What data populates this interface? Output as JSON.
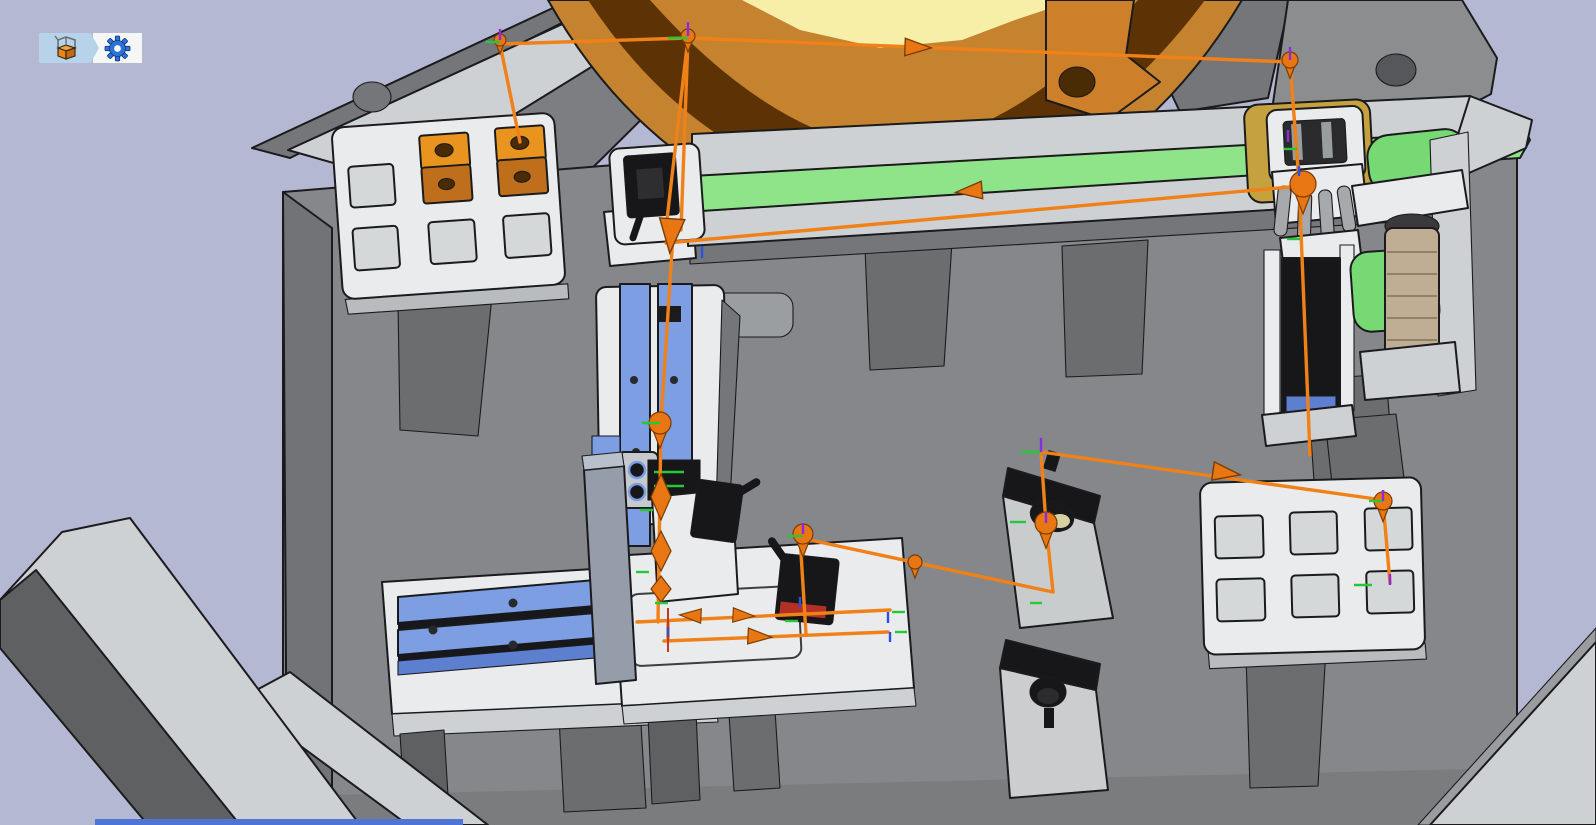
{
  "app": {
    "type": "3d-robot-simulation-viewport",
    "toolbar": {
      "buttons": [
        {
          "id": "workcell-component",
          "icon": "crate-3d-icon"
        },
        {
          "id": "settings",
          "icon": "gear-icon"
        }
      ]
    }
  },
  "colors": {
    "bg": "#b4b8d2",
    "plate": "#85878a",
    "plateChamfer": "#717376",
    "plateBottom": "#7a7c7e",
    "legDark": "#6b6d6f",
    "beamDark": "#5e6062",
    "grayLight": "#cdd1d3",
    "white": "#e9ebec",
    "pocket": "#d5d8d9",
    "blue": "#7d9ee2",
    "blueDeep": "#5d7fd0",
    "steel": "#959dab",
    "beltGreen": "#8fe48a",
    "blockGreen": "#77d973",
    "gold": "#c5a23f",
    "beige": "#bfae93",
    "black": "#17171a",
    "red": "#b33025",
    "bowlOrange": "#c5832f",
    "bowlBrown": "#5d3305",
    "bowlYellow": "#f7efa7",
    "cubeTop": "#e9941f",
    "cubeFront": "#bf6f1b",
    "holeDark": "#4a2c04",
    "outline": "#1b1b1d",
    "pathOrange": "#f08018",
    "arrowFill": "#e87612",
    "auxRed": "#c0392b",
    "tickGreen": "#27c837",
    "tickBlue": "#2a52e0",
    "tickPurple": "#8a2be2",
    "stripBlue": "#4f74d4",
    "toolbarBlue": "#b7d3e9",
    "toolbarWhite": "#f4f7f6",
    "gearBlue": "#2a72d9",
    "crateOrange": "#e8861c",
    "grayMid": "#7c7e81",
    "grayPanelA": "#74767a",
    "grayPanelB": "#8b8d8f",
    "barLight": "#b9bcbe"
  },
  "scene": {
    "parts": [
      "bowl-feeder",
      "conveyor",
      "conveyor-sensor",
      "left-pallet",
      "workpiece-cube-1",
      "workpiece-cube-2",
      "vertical-slide-unit",
      "horizontal-slide-unit",
      "assembly-fixture",
      "gripper-station",
      "pusher-slide",
      "feeder-motor",
      "inspection-stand-1",
      "inspection-stand-2",
      "right-pallet",
      "base-plate",
      "frame-beams",
      "robot-trajectory"
    ],
    "left_pallet": {
      "rows": 2,
      "cols": 3,
      "pockets": 6,
      "workpieces": 2
    },
    "right_pallet": {
      "rows": 2,
      "cols": 3,
      "pockets": 6,
      "workpieces": 0
    },
    "trajectory": {
      "segments": [
        [
          [
            520,
            142
          ],
          [
            500,
            44
          ],
          [
            688,
            38
          ],
          [
            1290,
            62
          ],
          [
            1299,
            182
          ],
          [
            1310,
            455
          ]
        ],
        [
          [
            688,
            38
          ],
          [
            666,
            228
          ]
        ],
        [
          [
            688,
            38
          ],
          [
            681,
            230
          ]
        ],
        [
          [
            673,
            235
          ],
          [
            661,
            422
          ],
          [
            658,
            622
          ]
        ],
        [
          [
            1301,
            186
          ],
          [
            666,
            243
          ]
        ],
        [
          [
            637,
            622
          ],
          [
            890,
            610
          ]
        ],
        [
          [
            668,
            622
          ],
          [
            668,
            641
          ]
        ],
        [
          [
            664,
            641
          ],
          [
            888,
            632
          ]
        ],
        [
          [
            800,
            537
          ],
          [
            806,
            634
          ]
        ],
        [
          [
            810,
            540
          ],
          [
            1053,
            592
          ]
        ],
        [
          [
            1053,
            592
          ],
          [
            1046,
            524
          ],
          [
            1041,
            452
          ]
        ],
        [
          [
            1041,
            452
          ],
          [
            1383,
            500
          ]
        ],
        [
          [
            1383,
            502
          ],
          [
            1390,
            583
          ]
        ]
      ],
      "aux_red_segments": [
        [
          [
            668,
            608
          ],
          [
            668,
            652
          ]
        ]
      ],
      "pins": [
        {
          "x": 500,
          "y": 40,
          "r": 6
        },
        {
          "x": 688,
          "y": 36,
          "r": 7
        },
        {
          "x": 1290,
          "y": 60,
          "r": 8
        },
        {
          "x": 1303,
          "y": 184,
          "r": 13
        },
        {
          "x": 660,
          "y": 423,
          "r": 11
        },
        {
          "x": 803,
          "y": 534,
          "r": 10
        },
        {
          "x": 915,
          "y": 562,
          "r": 7
        },
        {
          "x": 1046,
          "y": 523,
          "r": 11
        },
        {
          "x": 1383,
          "y": 501,
          "r": 9
        }
      ],
      "cones": [
        {
          "x": 671,
          "y": 236,
          "angle": 94,
          "s": 1.15
        }
      ],
      "diamonds": [
        {
          "x": 661,
          "y": 497,
          "h": 46
        },
        {
          "x": 661,
          "y": 551,
          "h": 40
        },
        {
          "x": 661,
          "y": 589,
          "h": 26
        }
      ],
      "arrows": [
        {
          "x": 905,
          "y": 47,
          "angle": 2,
          "s": 1.1
        },
        {
          "x": 982,
          "y": 190,
          "angle": 175,
          "s": 1.1
        },
        {
          "x": 1213,
          "y": 471,
          "angle": 8,
          "s": 1.15
        },
        {
          "x": 701,
          "y": 616,
          "angle": 183,
          "s": 0.9
        },
        {
          "x": 733,
          "y": 615,
          "angle": 3,
          "s": 0.9
        },
        {
          "x": 748,
          "y": 636,
          "angle": 3,
          "s": 1.0
        }
      ],
      "ticks": [
        {
          "x": 688,
          "y": 38,
          "angle": 180,
          "len": 20,
          "color": "green"
        },
        {
          "x": 500,
          "y": 42,
          "angle": 180,
          "len": 14,
          "color": "green"
        },
        {
          "x": 660,
          "y": 423,
          "angle": 180,
          "len": 18,
          "color": "green"
        },
        {
          "x": 803,
          "y": 536,
          "angle": 180,
          "len": 16,
          "color": "green"
        },
        {
          "x": 1041,
          "y": 452,
          "angle": 180,
          "len": 20,
          "color": "green"
        },
        {
          "x": 1026,
          "y": 522,
          "angle": 180,
          "len": 16,
          "color": "green"
        },
        {
          "x": 1383,
          "y": 501,
          "angle": 180,
          "len": 14,
          "color": "green"
        },
        {
          "x": 1372,
          "y": 585,
          "angle": 180,
          "len": 18,
          "color": "green"
        },
        {
          "x": 653,
          "y": 510,
          "angle": 180,
          "len": 13,
          "color": "green"
        },
        {
          "x": 649,
          "y": 572,
          "angle": 180,
          "len": 13,
          "color": "green"
        },
        {
          "x": 668,
          "y": 603,
          "angle": 180,
          "len": 13,
          "color": "green"
        },
        {
          "x": 798,
          "y": 621,
          "angle": 180,
          "len": 13,
          "color": "green"
        },
        {
          "x": 1042,
          "y": 603,
          "angle": 180,
          "len": 12,
          "color": "green"
        },
        {
          "x": 1297,
          "y": 149,
          "angle": 180,
          "len": 13,
          "color": "green"
        },
        {
          "x": 1300,
          "y": 239,
          "angle": 180,
          "len": 13,
          "color": "green"
        },
        {
          "x": 892,
          "y": 612,
          "angle": 0,
          "len": 13,
          "color": "green"
        },
        {
          "x": 895,
          "y": 632,
          "angle": 0,
          "len": 12,
          "color": "green"
        },
        {
          "x": 688,
          "y": 36,
          "angle": -90,
          "len": 14,
          "color": "purple"
        },
        {
          "x": 500,
          "y": 40,
          "angle": -90,
          "len": 11,
          "color": "purple"
        },
        {
          "x": 1290,
          "y": 60,
          "angle": -90,
          "len": 13,
          "color": "purple"
        },
        {
          "x": 1041,
          "y": 452,
          "angle": -90,
          "len": 14,
          "color": "purple"
        },
        {
          "x": 1383,
          "y": 501,
          "angle": -90,
          "len": 11,
          "color": "purple"
        },
        {
          "x": 803,
          "y": 534,
          "angle": -90,
          "len": 11,
          "color": "purple"
        },
        {
          "x": 1046,
          "y": 523,
          "angle": -90,
          "len": 11,
          "color": "purple"
        },
        {
          "x": 1390,
          "y": 585,
          "angle": -90,
          "len": 11,
          "color": "purple"
        },
        {
          "x": 1288,
          "y": 142,
          "angle": -90,
          "len": 12,
          "color": "purple"
        },
        {
          "x": 888,
          "y": 612,
          "angle": 90,
          "len": 11,
          "color": "blue"
        },
        {
          "x": 890,
          "y": 632,
          "angle": 90,
          "len": 10,
          "color": "blue"
        },
        {
          "x": 800,
          "y": 597,
          "angle": 90,
          "len": 10,
          "color": "blue"
        },
        {
          "x": 702,
          "y": 246,
          "angle": 90,
          "len": 12,
          "color": "blue"
        },
        {
          "x": 668,
          "y": 627,
          "angle": 90,
          "len": 10,
          "color": "blue"
        },
        {
          "x": 1299,
          "y": 166,
          "angle": 90,
          "len": 10,
          "color": "blue"
        }
      ]
    }
  }
}
